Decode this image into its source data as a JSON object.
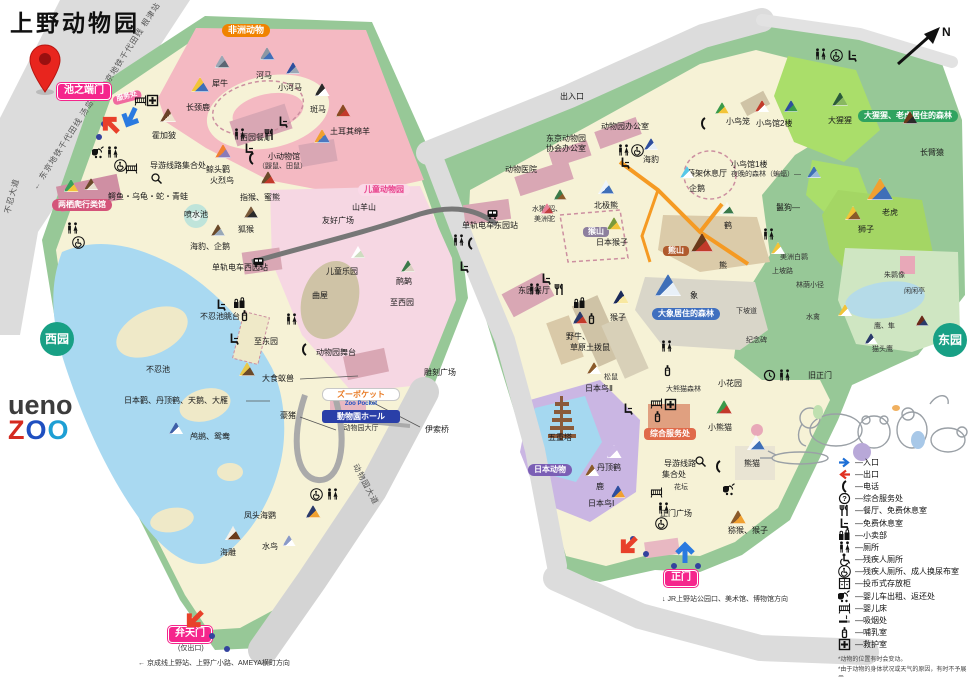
{
  "title": "上野动物园",
  "compass_label": "N",
  "logo": {
    "line1": "ueno",
    "zoo_letters": [
      {
        "ch": "Z",
        "c": "#d42a20"
      },
      {
        "ch": "O",
        "c": "#1e4fc0"
      },
      {
        "ch": "O",
        "c": "#1e9fd4"
      }
    ]
  },
  "colors": {
    "gate_pink": "#f5258c",
    "africa_orange": "#f08300",
    "park_green": "#97c897",
    "path_cream": "#f6f2d6",
    "pond_blue": "#a9d9f1",
    "west_badge_teal": "#18a085",
    "elephant_blue": "#3f6fbf",
    "gorilla_green": "#2fa35f"
  },
  "streets": [
    {
      "t": "← 东京地铁千代田线  汤岛站",
      "x": 30,
      "y": 186,
      "rot": -57
    },
    {
      "t": "东京地铁千代田线  根津站 →",
      "x": 98,
      "y": 86,
      "rot": -57
    },
    {
      "t": "不忍大道",
      "x": 2,
      "y": 212,
      "rot": -75
    },
    {
      "t": "动物园大道",
      "x": 360,
      "y": 462,
      "rot": 62
    }
  ],
  "gates": [
    {
      "t": "池之端门",
      "x": 57,
      "y": 83
    },
    {
      "t": "弁天门",
      "x": 168,
      "y": 626
    },
    {
      "t": "正门",
      "x": 664,
      "y": 570
    }
  ],
  "badges": [
    {
      "t": "非洲动物",
      "x": 222,
      "y": 24,
      "s": "b-orange"
    },
    {
      "t": "服务处",
      "x": 112,
      "y": 97,
      "s": "b-pinksm",
      "rot": -15
    },
    {
      "t": "两栖爬行类馆",
      "x": 52,
      "y": 199,
      "s": "b-rose"
    },
    {
      "t": "儿童动物园",
      "x": 358,
      "y": 184,
      "s": "b-kids"
    },
    {
      "t": "日本动物",
      "x": 528,
      "y": 464,
      "s": "b-purple"
    },
    {
      "t": "综合服务处",
      "x": 644,
      "y": 428,
      "s": "b-service"
    },
    {
      "t": "熊山",
      "x": 663,
      "y": 246,
      "s": "b-bear"
    },
    {
      "t": "猴山",
      "x": 583,
      "y": 227,
      "s": "b-monkey"
    },
    {
      "t": "大象居住的森林",
      "x": 652,
      "y": 308,
      "s": "b-bluepill"
    },
    {
      "t": "大猩猩、老虎居住的森林",
      "x": 858,
      "y": 110,
      "s": "b-greenpill"
    },
    {
      "t": "西园",
      "x": 40,
      "y": 322,
      "s": "b-circle"
    },
    {
      "t": "东园",
      "x": 933,
      "y": 323,
      "s": "b-circle"
    }
  ],
  "shop": {
    "pocket_jp": "ズーポケット",
    "pocket_en": "Zoo Pocket",
    "hall_jp": "動物園ホール",
    "hall_cn": "动物园大厅"
  },
  "labels": [
    {
      "t": "犀牛",
      "x": 212,
      "y": 80
    },
    {
      "t": "河马",
      "x": 256,
      "y": 72
    },
    {
      "t": "小河马",
      "x": 278,
      "y": 84
    },
    {
      "t": "长颈鹿",
      "x": 186,
      "y": 104
    },
    {
      "t": "霍加狓",
      "x": 152,
      "y": 132
    },
    {
      "t": "斑马",
      "x": 310,
      "y": 106
    },
    {
      "t": "土耳其绵羊",
      "x": 330,
      "y": 128
    },
    {
      "t": "西园餐厅",
      "x": 240,
      "y": 134
    },
    {
      "t": "导游线路集合处",
      "x": 150,
      "y": 162
    },
    {
      "t": "小动物馆",
      "x": 268,
      "y": 153
    },
    {
      "t": "（鼹鼠、田鼠）",
      "x": 258,
      "y": 163,
      "c": "tiny"
    },
    {
      "t": "鲸头鹳",
      "x": 206,
      "y": 166
    },
    {
      "t": "火烈鸟",
      "x": 210,
      "y": 177
    },
    {
      "t": "指猴、蜜熊",
      "x": 240,
      "y": 194
    },
    {
      "t": "狐猴",
      "x": 238,
      "y": 226
    },
    {
      "t": "喷水池",
      "x": 184,
      "y": 211
    },
    {
      "t": "海豹、企鹅",
      "x": 190,
      "y": 243
    },
    {
      "t": "单轨电车西园站",
      "x": 212,
      "y": 264
    },
    {
      "t": "鳄鱼・乌龟・蛇・青蛙",
      "x": 108,
      "y": 193
    },
    {
      "t": "不忍池眺台",
      "x": 200,
      "y": 313
    },
    {
      "t": "至东园",
      "x": 254,
      "y": 338
    },
    {
      "t": "不忍池",
      "x": 146,
      "y": 366
    },
    {
      "t": "大食蚁兽",
      "x": 262,
      "y": 375
    },
    {
      "t": "日本鹳、丹顶鹤、天鹅、大雁",
      "x": 124,
      "y": 397
    },
    {
      "t": "鸬鹚、鸳鸯",
      "x": 190,
      "y": 433
    },
    {
      "t": "豪猪",
      "x": 280,
      "y": 412
    },
    {
      "t": "凤头海鹦",
      "x": 244,
      "y": 512
    },
    {
      "t": "水鸟",
      "x": 262,
      "y": 543
    },
    {
      "t": "海雕",
      "x": 220,
      "y": 549
    },
    {
      "t": "(仅出口)",
      "x": 178,
      "y": 645,
      "c": "tiny"
    },
    {
      "t": "← 京成线上野站、上野广小路、AMEYA横町方向",
      "x": 138,
      "y": 660,
      "c": "tiny"
    },
    {
      "t": "伊索桥",
      "x": 425,
      "y": 426
    },
    {
      "t": "雕刻广场",
      "x": 424,
      "y": 369
    },
    {
      "t": "动物园舞台",
      "x": 316,
      "y": 349
    },
    {
      "t": "曲屋",
      "x": 312,
      "y": 292
    },
    {
      "t": "儿童乐园",
      "x": 326,
      "y": 268
    },
    {
      "t": "山羊山",
      "x": 352,
      "y": 204
    },
    {
      "t": "友好广场",
      "x": 322,
      "y": 217
    },
    {
      "t": "鸸鹋",
      "x": 396,
      "y": 278
    },
    {
      "t": "至西园",
      "x": 390,
      "y": 299
    },
    {
      "t": "出入口",
      "x": 560,
      "y": 93
    },
    {
      "t": "动物园办公室",
      "x": 601,
      "y": 123
    },
    {
      "t": "东京动物园",
      "x": 546,
      "y": 135
    },
    {
      "t": "协会办公室",
      "x": 546,
      "y": 145
    },
    {
      "t": "动物医院",
      "x": 505,
      "y": 166
    },
    {
      "t": "单轨电车东园站",
      "x": 462,
      "y": 222
    },
    {
      "t": "海豹",
      "x": 643,
      "y": 156
    },
    {
      "t": "企鹅",
      "x": 689,
      "y": 185
    },
    {
      "t": "北极熊",
      "x": 594,
      "y": 202
    },
    {
      "t": "日本猴子",
      "x": 596,
      "y": 239
    },
    {
      "t": "水獭/貂、",
      "x": 532,
      "y": 206,
      "c": "tiny"
    },
    {
      "t": "美洲驼",
      "x": 534,
      "y": 216,
      "c": "tiny"
    },
    {
      "t": "东园餐厅",
      "x": 518,
      "y": 287
    },
    {
      "t": "鹤",
      "x": 724,
      "y": 222
    },
    {
      "t": "熊",
      "x": 719,
      "y": 262
    },
    {
      "t": "象",
      "x": 690,
      "y": 292
    },
    {
      "t": "下坡道",
      "x": 736,
      "y": 308,
      "c": "tiny"
    },
    {
      "t": "纪念碑",
      "x": 746,
      "y": 337,
      "c": "tiny"
    },
    {
      "t": "猴子",
      "x": 610,
      "y": 314
    },
    {
      "t": "野牛、",
      "x": 566,
      "y": 333
    },
    {
      "t": "草原土拨鼠",
      "x": 570,
      "y": 344
    },
    {
      "t": "松鼠",
      "x": 604,
      "y": 374,
      "c": "tiny"
    },
    {
      "t": "日本鸟Ⅱ",
      "x": 585,
      "y": 385
    },
    {
      "t": "大熊猫森林",
      "x": 666,
      "y": 386,
      "c": "tiny"
    },
    {
      "t": "小花园",
      "x": 718,
      "y": 380
    },
    {
      "t": "小熊猫",
      "x": 708,
      "y": 424
    },
    {
      "t": "熊猫",
      "x": 744,
      "y": 460
    },
    {
      "t": "导游线路",
      "x": 664,
      "y": 460
    },
    {
      "t": "集合处",
      "x": 662,
      "y": 471
    },
    {
      "t": "花坛",
      "x": 674,
      "y": 484,
      "c": "tiny"
    },
    {
      "t": "正门广场",
      "x": 660,
      "y": 510
    },
    {
      "t": "丹顶鹤",
      "x": 597,
      "y": 464
    },
    {
      "t": "鹿",
      "x": 596,
      "y": 483
    },
    {
      "t": "五重塔",
      "x": 548,
      "y": 434
    },
    {
      "t": "日本鸟Ⅰ",
      "x": 588,
      "y": 500
    },
    {
      "t": "猕猴、猴子",
      "x": 728,
      "y": 527
    },
    {
      "t": "↓ JR上野站公园口、美术馆、博物馆方向",
      "x": 662,
      "y": 596,
      "c": "tiny"
    },
    {
      "t": "小鸟笼",
      "x": 726,
      "y": 118
    },
    {
      "t": "小鸟馆2楼",
      "x": 756,
      "y": 120
    },
    {
      "t": "小鸟馆1楼",
      "x": 731,
      "y": 161
    },
    {
      "t": "夜晚的森林（蝙蝠）—",
      "x": 731,
      "y": 171,
      "c": "tiny"
    },
    {
      "t": "藤架休息厅",
      "x": 687,
      "y": 170
    },
    {
      "t": "鬣狗—",
      "x": 776,
      "y": 204
    },
    {
      "t": "大猩猩",
      "x": 828,
      "y": 117
    },
    {
      "t": "长臂猿",
      "x": 920,
      "y": 149
    },
    {
      "t": "老虎",
      "x": 882,
      "y": 209
    },
    {
      "t": "狮子",
      "x": 858,
      "y": 226
    },
    {
      "t": "美洲白鹮",
      "x": 780,
      "y": 254,
      "c": "tiny"
    },
    {
      "t": "上坡路",
      "x": 772,
      "y": 268,
      "c": "tiny"
    },
    {
      "t": "林荫小径",
      "x": 796,
      "y": 282,
      "c": "tiny"
    },
    {
      "t": "朱鹮像",
      "x": 884,
      "y": 272,
      "c": "tiny"
    },
    {
      "t": "闲闲亭",
      "x": 904,
      "y": 288,
      "c": "tiny"
    },
    {
      "t": "水禽",
      "x": 806,
      "y": 314,
      "c": "tiny"
    },
    {
      "t": "鹰、隼",
      "x": 874,
      "y": 323,
      "c": "tiny"
    },
    {
      "t": "猫头鹰",
      "x": 872,
      "y": 346,
      "c": "tiny"
    },
    {
      "t": "旧正门",
      "x": 808,
      "y": 372
    }
  ],
  "triangles": [
    {
      "x": 200,
      "y": 92,
      "w": 18,
      "c1": "#f2c438",
      "c2": "#3f6fb8"
    },
    {
      "x": 222,
      "y": 68,
      "w": 15,
      "c1": "#9aa7b5",
      "c2": "#5a6673"
    },
    {
      "x": 267,
      "y": 60,
      "w": 15,
      "c1": "#8a97a4",
      "c2": "#3f6fb8"
    },
    {
      "x": 293,
      "y": 74,
      "w": 14,
      "c1": "#2e4e9e",
      "c2": "#9aa7b5"
    },
    {
      "x": 168,
      "y": 122,
      "w": 16,
      "c1": "#6b4328",
      "c2": "#efe3cf"
    },
    {
      "x": 322,
      "y": 96,
      "w": 15,
      "c1": "#2a2a2a",
      "c2": "#ffffff"
    },
    {
      "x": 343,
      "y": 117,
      "w": 15,
      "c1": "#8a4a22",
      "c2": "#c23a2a"
    },
    {
      "x": 71,
      "y": 192,
      "w": 15,
      "c1": "#3aa05a",
      "c2": "#f2c438"
    },
    {
      "x": 91,
      "y": 190,
      "w": 14,
      "c1": "#6b4a2a",
      "c2": "#e8e0d0"
    },
    {
      "x": 223,
      "y": 158,
      "w": 16,
      "c1": "#f08030",
      "c2": "#8a7ab8"
    },
    {
      "x": 322,
      "y": 143,
      "w": 16,
      "c1": "#f0a030",
      "c2": "#4a78c0"
    },
    {
      "x": 268,
      "y": 184,
      "w": 15,
      "c1": "#6b4a2a",
      "c2": "#c23a2a"
    },
    {
      "x": 251,
      "y": 218,
      "w": 14,
      "c1": "#7a5a3a",
      "c2": "#2a2a2a"
    },
    {
      "x": 218,
      "y": 236,
      "w": 14,
      "c1": "#6b4a2a",
      "c2": "#98a8b8"
    },
    {
      "x": 247,
      "y": 376,
      "w": 16,
      "c1": "#e8c84a",
      "c2": "#6b4a2a"
    },
    {
      "x": 176,
      "y": 434,
      "w": 14,
      "c1": "#3f5fa8",
      "c2": "#ffffff"
    },
    {
      "x": 233,
      "y": 540,
      "w": 16,
      "c1": "#f5f0e8",
      "c2": "#6b3a1a"
    },
    {
      "x": 313,
      "y": 518,
      "w": 15,
      "c1": "#2a3a6a",
      "c2": "#f0a030"
    },
    {
      "x": 289,
      "y": 546,
      "w": 13,
      "c1": "#8a9ac8",
      "c2": "#ffffff"
    },
    {
      "x": 408,
      "y": 272,
      "w": 14,
      "c1": "#3a7a4a",
      "c2": "#d8d0c0"
    },
    {
      "x": 358,
      "y": 258,
      "w": 14,
      "c1": "#ffffff",
      "c2": "#cddcc0"
    },
    {
      "x": 651,
      "y": 150,
      "w": 14,
      "c1": "#2e4e9e",
      "c2": "#e8f0f8"
    },
    {
      "x": 687,
      "y": 178,
      "w": 14,
      "c1": "#58c8e8",
      "c2": "#ffffff"
    },
    {
      "x": 606,
      "y": 194,
      "w": 16,
      "c1": "#eef4fa",
      "c2": "#3f6fb8"
    },
    {
      "x": 614,
      "y": 230,
      "w": 15,
      "c1": "#7a9a3a",
      "c2": "#f2c438"
    },
    {
      "x": 560,
      "y": 200,
      "w": 13,
      "c1": "#3a7a4a",
      "c2": "#8a5a2a"
    },
    {
      "x": 547,
      "y": 214,
      "w": 13,
      "c1": "#e88098",
      "c2": "#c24040"
    },
    {
      "x": 727,
      "y": 214,
      "w": 14,
      "c1": "#f8f8f0",
      "c2": "#3a7a4a"
    },
    {
      "x": 702,
      "y": 252,
      "w": 22,
      "c1": "#6b3a1a",
      "c2": "#c23a2a"
    },
    {
      "x": 668,
      "y": 296,
      "w": 26,
      "c1": "#3f6fb8",
      "c2": "#e8f0f8"
    },
    {
      "x": 621,
      "y": 304,
      "w": 16,
      "c1": "#1a2a5a",
      "c2": "#f8e8a0"
    },
    {
      "x": 580,
      "y": 324,
      "w": 15,
      "c1": "#2a3a6a",
      "c2": "#c23a2a"
    },
    {
      "x": 594,
      "y": 374,
      "w": 14,
      "c1": "#8a5a2a",
      "c2": "#ffffff"
    },
    {
      "x": 724,
      "y": 414,
      "w": 16,
      "c1": "#3a9a4a",
      "c2": "#c23a2a"
    },
    {
      "x": 756,
      "y": 450,
      "w": 18,
      "c1": "#f8f8f8",
      "c2": "#3f6fb8"
    },
    {
      "x": 614,
      "y": 458,
      "w": 15,
      "c1": "#cbb7e4",
      "c2": "#ffffff"
    },
    {
      "x": 592,
      "y": 476,
      "w": 14,
      "c1": "#8a5a2a",
      "c2": "#ffffff"
    },
    {
      "x": 618,
      "y": 498,
      "w": 15,
      "c1": "#2e4e9e",
      "c2": "#f0a030"
    },
    {
      "x": 738,
      "y": 524,
      "w": 16,
      "c1": "#8a5a2a",
      "c2": "#f0a030"
    },
    {
      "x": 722,
      "y": 114,
      "w": 14,
      "c1": "#3a9a4a",
      "c2": "#f2c438"
    },
    {
      "x": 762,
      "y": 112,
      "w": 14,
      "c1": "#c23a2a",
      "c2": "#ffffff"
    },
    {
      "x": 791,
      "y": 112,
      "w": 14,
      "c1": "#2e4e9e",
      "c2": "#3a9a4a"
    },
    {
      "x": 840,
      "y": 106,
      "w": 16,
      "c1": "#2a5a3a",
      "c2": "#88b860"
    },
    {
      "x": 910,
      "y": 124,
      "w": 15,
      "c1": "#6b3a1a",
      "c2": "#2a2a2a"
    },
    {
      "x": 880,
      "y": 200,
      "w": 26,
      "c1": "#f0a030",
      "c2": "#3f6fb8"
    },
    {
      "x": 853,
      "y": 220,
      "w": 16,
      "c1": "#f2c438",
      "c2": "#8a5a2a"
    },
    {
      "x": 814,
      "y": 178,
      "w": 14,
      "c1": "#3f6fb8",
      "c2": "#98b8d8"
    },
    {
      "x": 778,
      "y": 254,
      "w": 14,
      "c1": "#f2c438",
      "c2": "#ffffff"
    },
    {
      "x": 845,
      "y": 316,
      "w": 14,
      "c1": "#f2c438",
      "c2": "#ffffff"
    },
    {
      "x": 922,
      "y": 326,
      "w": 13,
      "c1": "#6b2a1a",
      "c2": "#2a3a6a"
    },
    {
      "x": 871,
      "y": 344,
      "w": 13,
      "c1": "#2a3a6a",
      "c2": "#ffffff"
    }
  ],
  "map_icons": [
    {
      "i": "toilet",
      "x": 66,
      "y": 222
    },
    {
      "i": "wheelchair-circle",
      "x": 72,
      "y": 236
    },
    {
      "i": "stroller",
      "x": 92,
      "y": 146
    },
    {
      "i": "toilet",
      "x": 106,
      "y": 146
    },
    {
      "i": "wheelchair-circle",
      "x": 114,
      "y": 159
    },
    {
      "i": "crib",
      "x": 125,
      "y": 162
    },
    {
      "i": "crib",
      "x": 134,
      "y": 94
    },
    {
      "i": "first-aid",
      "x": 146,
      "y": 94
    },
    {
      "i": "magnifier",
      "x": 150,
      "y": 172
    },
    {
      "i": "toilet",
      "x": 233,
      "y": 128
    },
    {
      "i": "restaurant",
      "x": 263,
      "y": 128
    },
    {
      "i": "rest-area",
      "x": 243,
      "y": 142
    },
    {
      "i": "phone",
      "x": 245,
      "y": 152
    },
    {
      "i": "rest-area",
      "x": 277,
      "y": 115
    },
    {
      "i": "rest-area",
      "x": 215,
      "y": 298
    },
    {
      "i": "shop",
      "x": 233,
      "y": 297
    },
    {
      "i": "nursing",
      "x": 238,
      "y": 309
    },
    {
      "i": "rest-area",
      "x": 228,
      "y": 332
    },
    {
      "i": "toilet",
      "x": 285,
      "y": 313
    },
    {
      "i": "phone",
      "x": 298,
      "y": 343
    },
    {
      "i": "wheelchair-circle",
      "x": 310,
      "y": 488
    },
    {
      "i": "toilet",
      "x": 326,
      "y": 488
    },
    {
      "i": "train",
      "x": 252,
      "y": 256
    },
    {
      "i": "train",
      "x": 486,
      "y": 208
    },
    {
      "i": "toilet",
      "x": 617,
      "y": 144
    },
    {
      "i": "wheelchair-circle",
      "x": 631,
      "y": 144
    },
    {
      "i": "rest-area",
      "x": 619,
      "y": 156
    },
    {
      "i": "toilet",
      "x": 452,
      "y": 234
    },
    {
      "i": "phone",
      "x": 464,
      "y": 237
    },
    {
      "i": "rest-area",
      "x": 540,
      "y": 272
    },
    {
      "i": "toilet",
      "x": 528,
      "y": 283
    },
    {
      "i": "restaurant",
      "x": 553,
      "y": 283
    },
    {
      "i": "rest-area",
      "x": 458,
      "y": 260
    },
    {
      "i": "toilet",
      "x": 762,
      "y": 228
    },
    {
      "i": "toilet",
      "x": 814,
      "y": 48
    },
    {
      "i": "wheelchair-circle",
      "x": 830,
      "y": 49
    },
    {
      "i": "rest-area",
      "x": 846,
      "y": 49
    },
    {
      "i": "phone",
      "x": 697,
      "y": 117
    },
    {
      "i": "shop",
      "x": 573,
      "y": 297
    },
    {
      "i": "nursing",
      "x": 585,
      "y": 312
    },
    {
      "i": "toilet",
      "x": 660,
      "y": 340
    },
    {
      "i": "nursing",
      "x": 661,
      "y": 364
    },
    {
      "i": "crib",
      "x": 650,
      "y": 397
    },
    {
      "i": "first-aid",
      "x": 664,
      "y": 398
    },
    {
      "i": "nursing",
      "x": 651,
      "y": 410
    },
    {
      "i": "rest-area",
      "x": 622,
      "y": 402
    },
    {
      "i": "magnifier",
      "x": 694,
      "y": 455
    },
    {
      "i": "phone",
      "x": 712,
      "y": 460
    },
    {
      "i": "clock",
      "x": 763,
      "y": 369
    },
    {
      "i": "toilet",
      "x": 778,
      "y": 369
    },
    {
      "i": "stroller",
      "x": 723,
      "y": 483
    },
    {
      "i": "crib",
      "x": 650,
      "y": 486
    },
    {
      "i": "toilet",
      "x": 657,
      "y": 502
    },
    {
      "i": "wheelchair-circle",
      "x": 655,
      "y": 517
    }
  ],
  "dots": [
    {
      "x": 101,
      "y": 121
    },
    {
      "x": 96,
      "y": 134
    },
    {
      "x": 209,
      "y": 633
    },
    {
      "x": 224,
      "y": 646
    },
    {
      "x": 630,
      "y": 536
    },
    {
      "x": 643,
      "y": 551
    },
    {
      "x": 671,
      "y": 563
    },
    {
      "x": 695,
      "y": 563
    }
  ],
  "arrows": [
    {
      "x": 98,
      "y": 112,
      "rot": -135,
      "c": "#e8402a"
    },
    {
      "x": 118,
      "y": 104,
      "rot": 115,
      "c": "#2a7ae0"
    },
    {
      "x": 182,
      "y": 606,
      "rot": 135,
      "c": "#e8402a"
    },
    {
      "x": 616,
      "y": 532,
      "rot": 135,
      "c": "#e8402a"
    },
    {
      "x": 672,
      "y": 540,
      "rot": -90,
      "c": "#2a7ae0"
    }
  ],
  "legend": {
    "items": [
      {
        "icon": "entrance-arrow",
        "label": "—入口"
      },
      {
        "icon": "exit-arrow",
        "label": "—出口"
      },
      {
        "icon": "phone",
        "label": "—电话"
      },
      {
        "icon": "info",
        "label": "—综合服务处"
      },
      {
        "icon": "restaurant",
        "label": "—餐厅、免费休息室"
      },
      {
        "icon": "rest-area",
        "label": "—免费休息室"
      },
      {
        "icon": "shop",
        "label": "—小卖部"
      },
      {
        "icon": "toilet",
        "label": "—厕所"
      },
      {
        "icon": "wheelchair",
        "label": "—残疾人厕所"
      },
      {
        "icon": "wheelchair-circle",
        "label": "—残疾人厕所、成人换尿布室"
      },
      {
        "icon": "locker",
        "label": "—投币式存放柜"
      },
      {
        "icon": "stroller",
        "label": "—婴儿车出租、返还处"
      },
      {
        "icon": "crib",
        "label": "—婴儿床"
      },
      {
        "icon": "smoking",
        "label": "—吸烟处"
      },
      {
        "icon": "nursing",
        "label": "—哺乳室"
      },
      {
        "icon": "first-aid",
        "label": "—救护室"
      }
    ],
    "notes": [
      "*动物的位置有时会变动。",
      "*由于动物的身体状况或天气的原因，有时不予展示。"
    ]
  }
}
